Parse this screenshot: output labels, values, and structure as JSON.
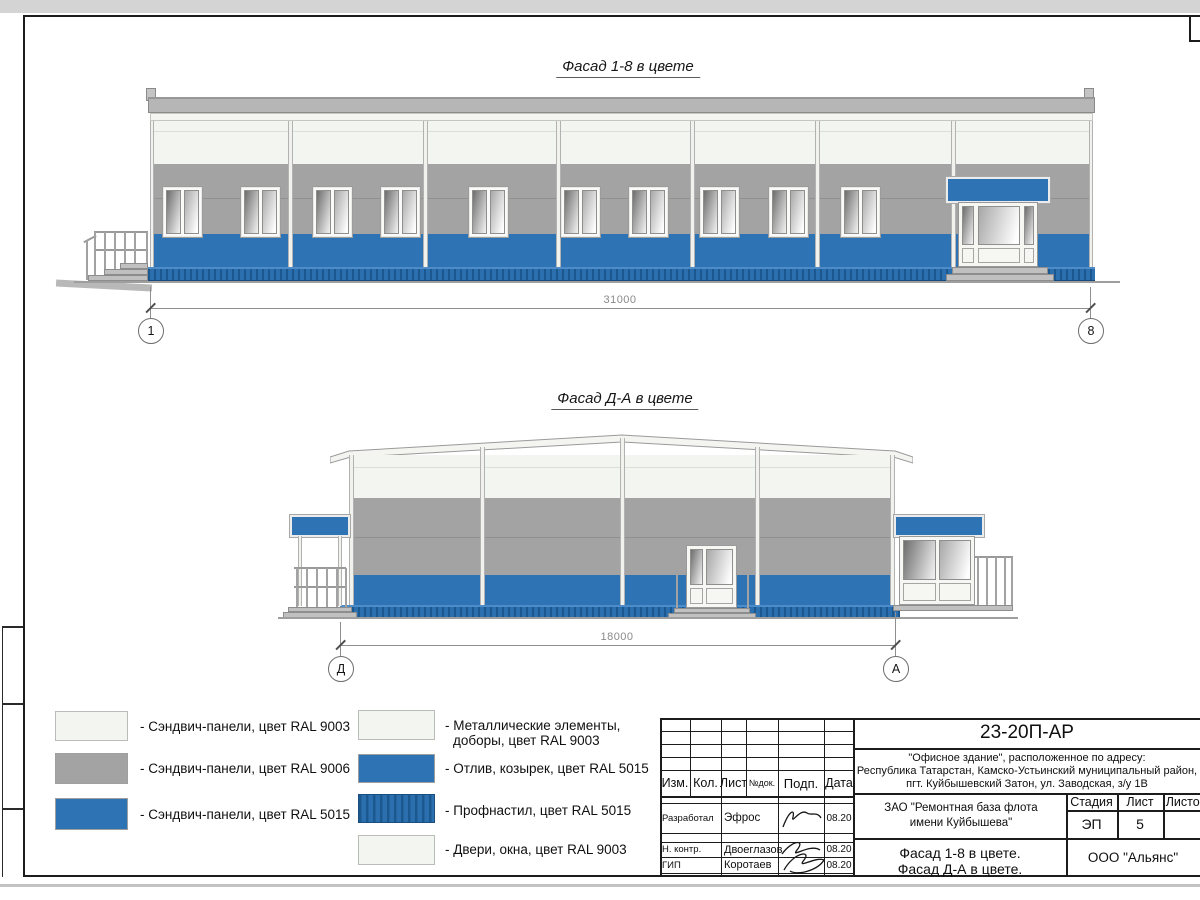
{
  "facade1": {
    "title": "Фасад 1-8 в цвете",
    "dimension": "31000",
    "axis_left": "1",
    "axis_right": "8"
  },
  "facade2": {
    "title": "Фасад Д-А в цвете",
    "dimension": "18000",
    "axis_left": "Д",
    "axis_right": "А"
  },
  "legend": {
    "left": [
      "- Сэндвич-панели, цвет RAL 9003",
      "- Сэндвич-панели, цвет RAL 9006",
      "- Сэндвич-панели, цвет RAL 5015"
    ],
    "right": [
      {
        "line1": "- Металлические элементы,",
        "line2": "доборы, цвет RAL 9003"
      },
      {
        "line1": "- Отлив, козырек, цвет RAL 5015"
      },
      {
        "line1": "- Профнастил, цвет RAL 5015"
      },
      {
        "line1": "- Двери, окна, цвет RAL 9003"
      }
    ]
  },
  "titleblock": {
    "doc_number": "23-20П-АР",
    "address1": "\"Офисное здание\", расположенное по адресу:",
    "address2": "Республика Татарстан, Камско-Устьинский муниципальный район,",
    "address3": "пгт. Куйбышевский Затон, ул. Заводская, з/у 1В",
    "col_headers": {
      "izm": "Изм.",
      "kol": "Кол.",
      "list": "Лист",
      "ndok": "№док.",
      "podp": "Подп.",
      "data": "Дата"
    },
    "rows": [
      {
        "role": "Разработал",
        "name": "Эфрос",
        "date": "08.20"
      },
      {
        "role": "Н. контр.",
        "name": "Двоеглазов",
        "date": "08.20"
      },
      {
        "role": "ГИП",
        "name": "Коротаев",
        "date": "08.20"
      }
    ],
    "client1": "ЗАО \"Ремонтная база флота",
    "client2": "имени Куйбышева\"",
    "stage_h": "Стадия",
    "list_h": "Лист",
    "listov_h": "Листов",
    "stage": "ЭП",
    "sheet": "5",
    "title1": "Фасад 1-8 в цвете.",
    "title2": "Фасад Д-А в цвете.",
    "company": "ООО \"Альянс\""
  },
  "colors": {
    "accent_blue": "#2e74b5",
    "panel_gray": "#a3a3a3",
    "panel_white": "#f3f5f0",
    "profnastil_blue": "#2b6fae"
  }
}
